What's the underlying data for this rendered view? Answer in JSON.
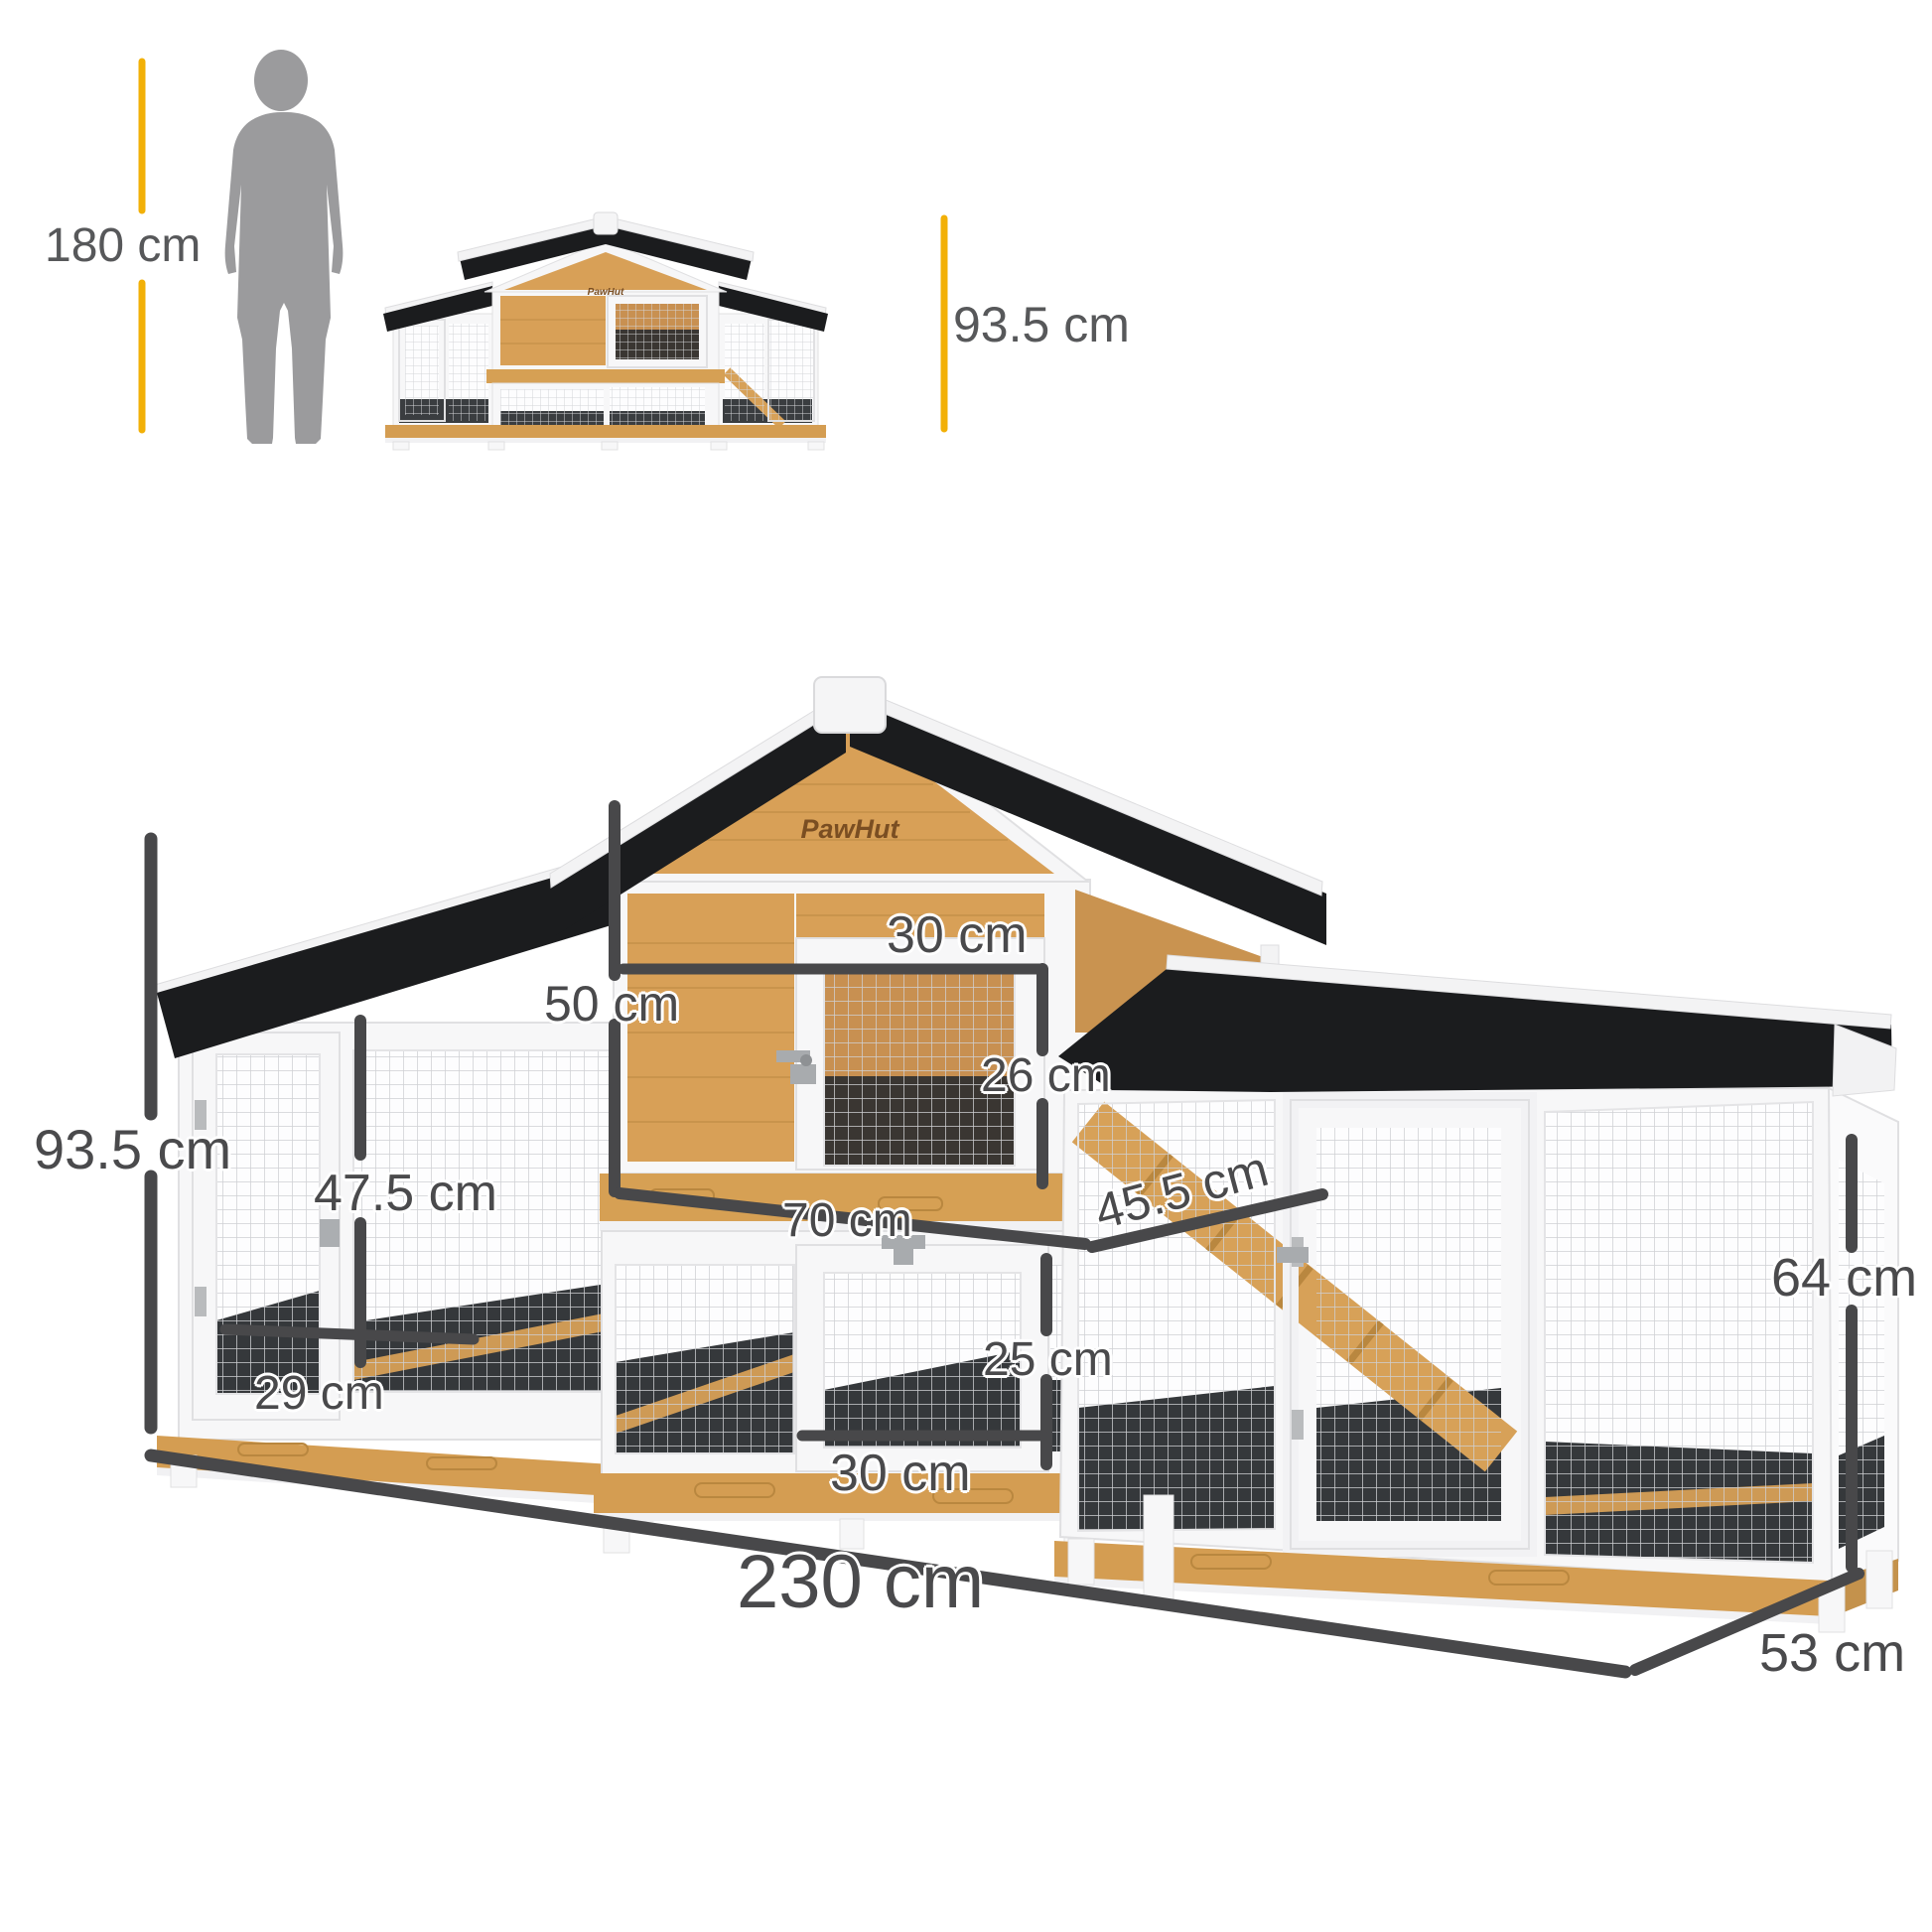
{
  "brand": {
    "logo_text": "PawHut"
  },
  "scale_reference": {
    "person_height": "180 cm",
    "front_view_height": "93.5 cm"
  },
  "dimension_labels": {
    "overall_height": "93.5 cm",
    "left_door_height": "47.5 cm",
    "left_door_width": "29 cm",
    "upper_hutch_height": "50 cm",
    "upper_door_width": "30 cm",
    "upper_door_height": "26 cm",
    "upper_tier_width": "70 cm",
    "ramp_length": "45.5 cm",
    "lower_door_height": "25 cm",
    "lower_door_width": "30 cm",
    "overall_width": "230 cm",
    "overall_depth": "53 cm",
    "right_run_height": "64 cm"
  },
  "colors": {
    "accent_yellow": "#F2B007",
    "dimension_gray": "#48484A",
    "roof_black": "#1B1C1E",
    "wood_tan": "#D9A35C",
    "frame_white": "#F7F7F8",
    "silhouette_gray": "#9B9B9D"
  }
}
